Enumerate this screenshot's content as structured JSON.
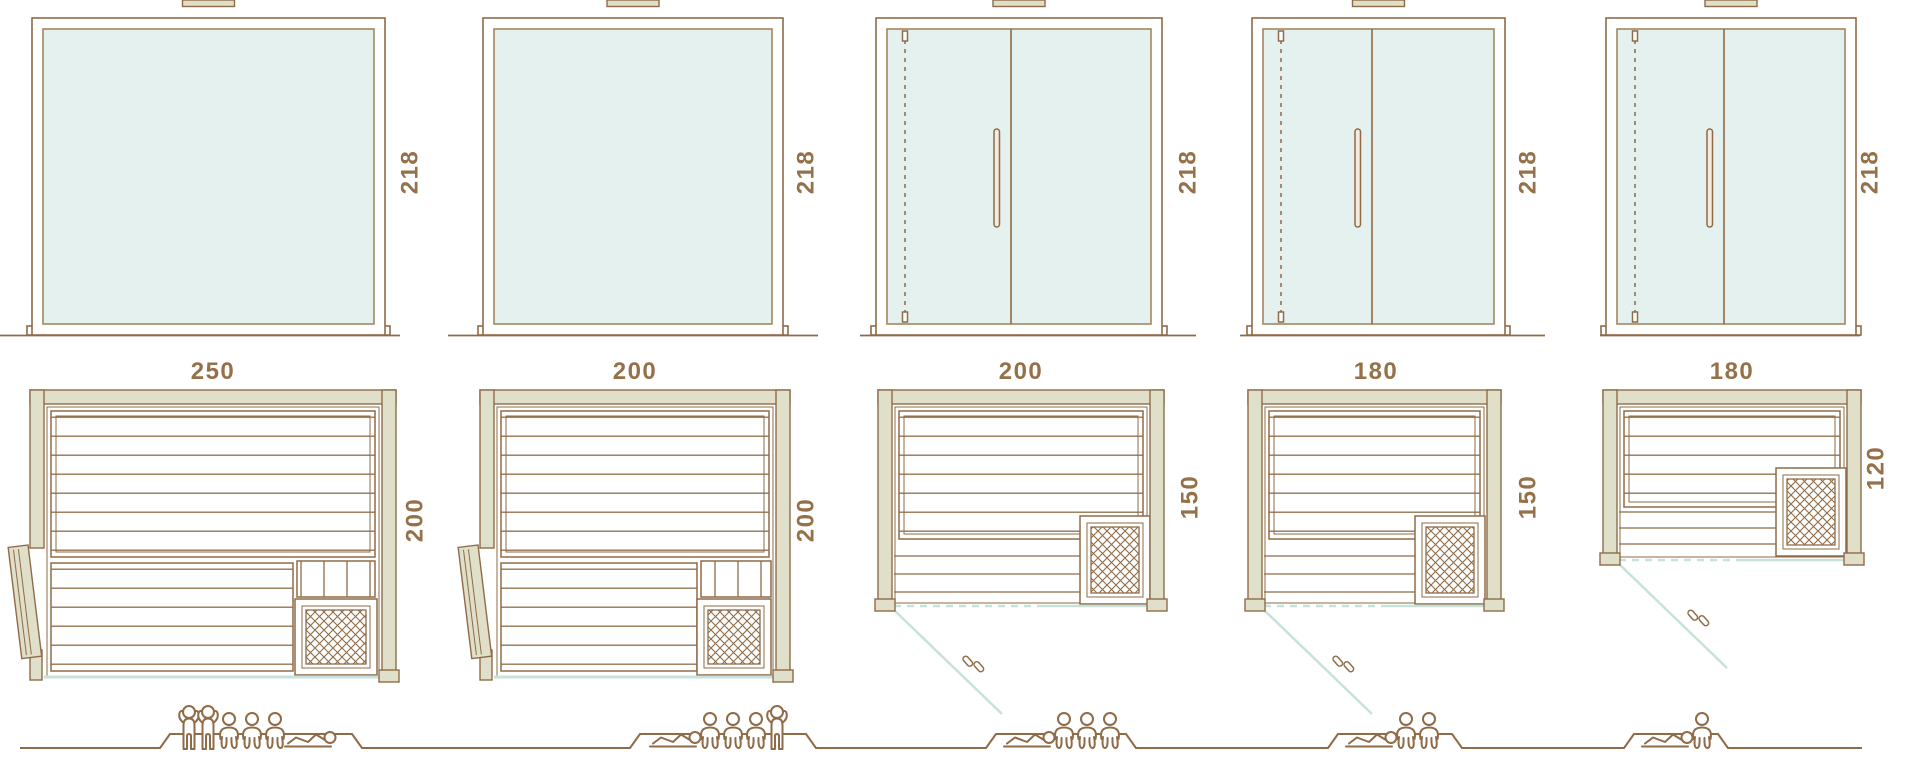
{
  "colors": {
    "line": "#8f6b47",
    "wall_fill": "#e0dfc9",
    "glass_fill": "#e4f1ee",
    "glass_edge": "#a3875e",
    "glass_line": "#c7e2db",
    "label": "#957149"
  },
  "labels": {
    "height": [
      "218",
      "218",
      "218",
      "218",
      "218"
    ],
    "width": [
      "250",
      "200",
      "200",
      "180",
      "180"
    ],
    "depth": [
      "200",
      "200",
      "150",
      "150",
      "120"
    ]
  },
  "people": {
    "col1": [
      "standing",
      "standing",
      "seated",
      "seated",
      "seated",
      "lying"
    ],
    "col2": [
      "lying",
      "seated",
      "seated",
      "seated",
      "standing"
    ],
    "col3": [
      "lying",
      "seated",
      "seated",
      "seated"
    ],
    "col4": [
      "lying",
      "seated",
      "seated"
    ],
    "col5": [
      "lying",
      "seated"
    ]
  }
}
